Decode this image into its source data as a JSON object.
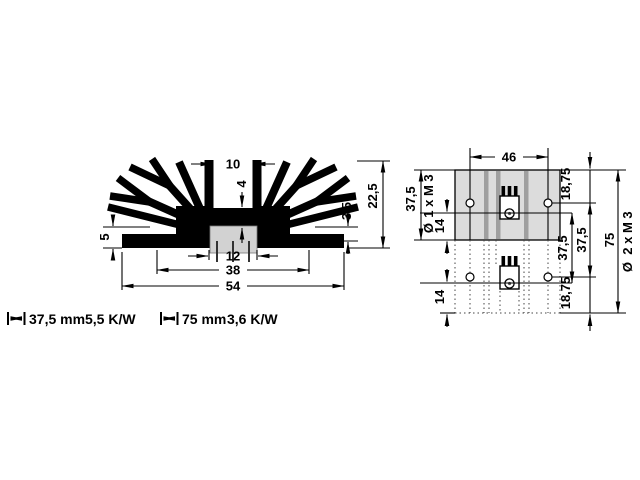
{
  "drawing": {
    "cross_section": {
      "slot_width": "10",
      "web_thickness": "4",
      "base_step": "3,5",
      "overall_height": "22,5",
      "flange_height": "5",
      "contact_width": "12",
      "inner_width": "38",
      "overall_width": "54"
    },
    "top_view": {
      "hole_spacing": "46",
      "length_short": "37,5",
      "phi": "Ø",
      "thread_short": "1 x M 3",
      "hole_offset_top": "14",
      "edge_to_hole_top": "18,75",
      "pkg_pitch": "37,5",
      "hole_pitch": "37,5",
      "length_long": "75",
      "thread_long": "2 x M 3",
      "hole_offset_bottom": "14",
      "edge_to_hole_bottom": "18,75"
    },
    "specs": [
      {
        "length": "37,5 mm",
        "resistance": "5,5 K/W"
      },
      {
        "length": "75 mm",
        "resistance": "3,6 K/W"
      }
    ]
  }
}
